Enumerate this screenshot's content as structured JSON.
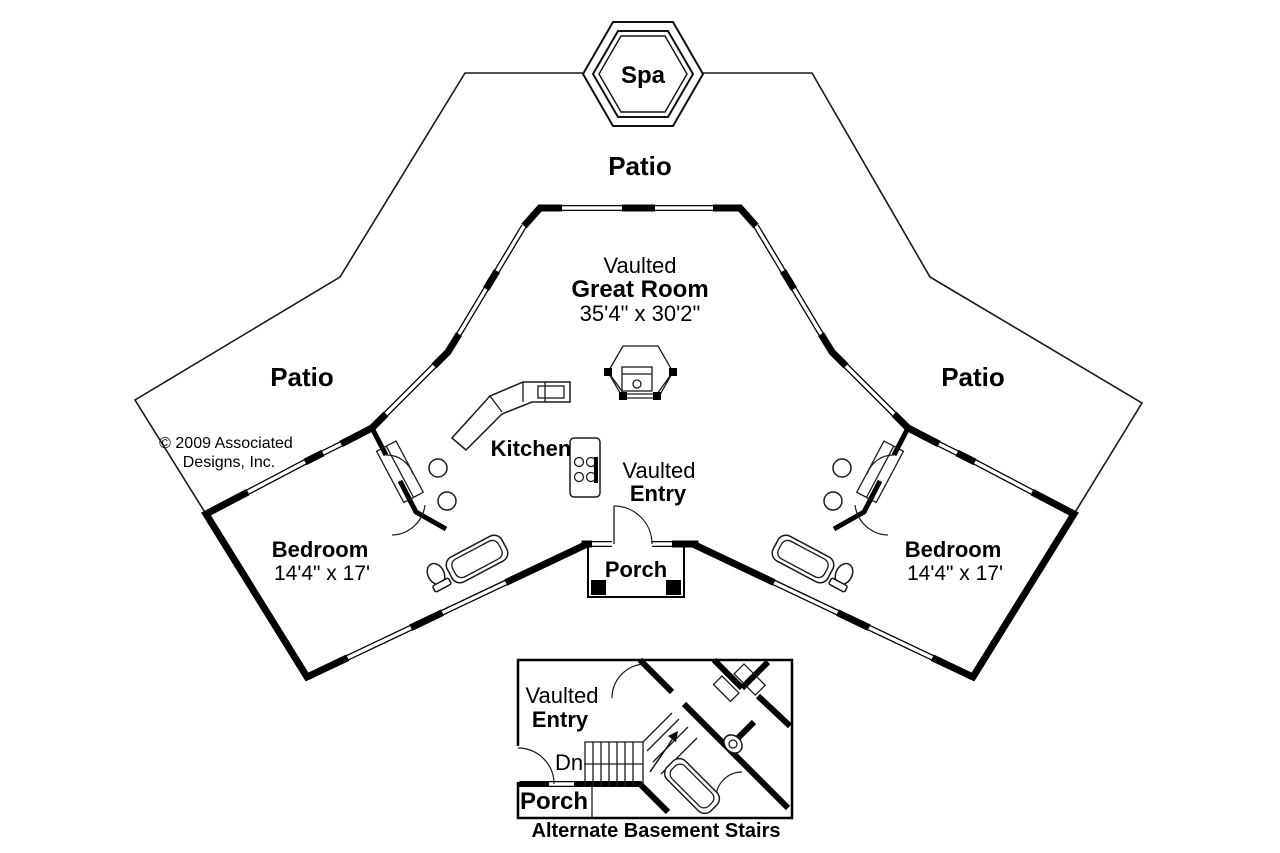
{
  "plan": {
    "spa_label": "Spa",
    "patio_top": "Patio",
    "patio_left": "Patio",
    "patio_right": "Patio",
    "great_room": {
      "line1": "Vaulted",
      "line2": "Great Room",
      "dims": "35'4\" x 30'2\""
    },
    "kitchen_label": "Kitchen",
    "entry": {
      "line1": "Vaulted",
      "line2": "Entry"
    },
    "porch_label": "Porch",
    "bedroom_left": {
      "name": "Bedroom",
      "dims": "14'4\" x 17'"
    },
    "bedroom_right": {
      "name": "Bedroom",
      "dims": "14'4\" x 17'"
    },
    "copyright": {
      "line1": "© 2009 Associated",
      "line2": "Designs, Inc."
    }
  },
  "inset": {
    "entry": {
      "line1": "Vaulted",
      "line2": "Entry"
    },
    "stairs_label": "Dn",
    "porch_label": "Porch",
    "caption": "Alternate Basement Stairs"
  },
  "colors": {
    "wall": "#000000",
    "thin_line": "#1a1a1a",
    "background": "#ffffff"
  }
}
